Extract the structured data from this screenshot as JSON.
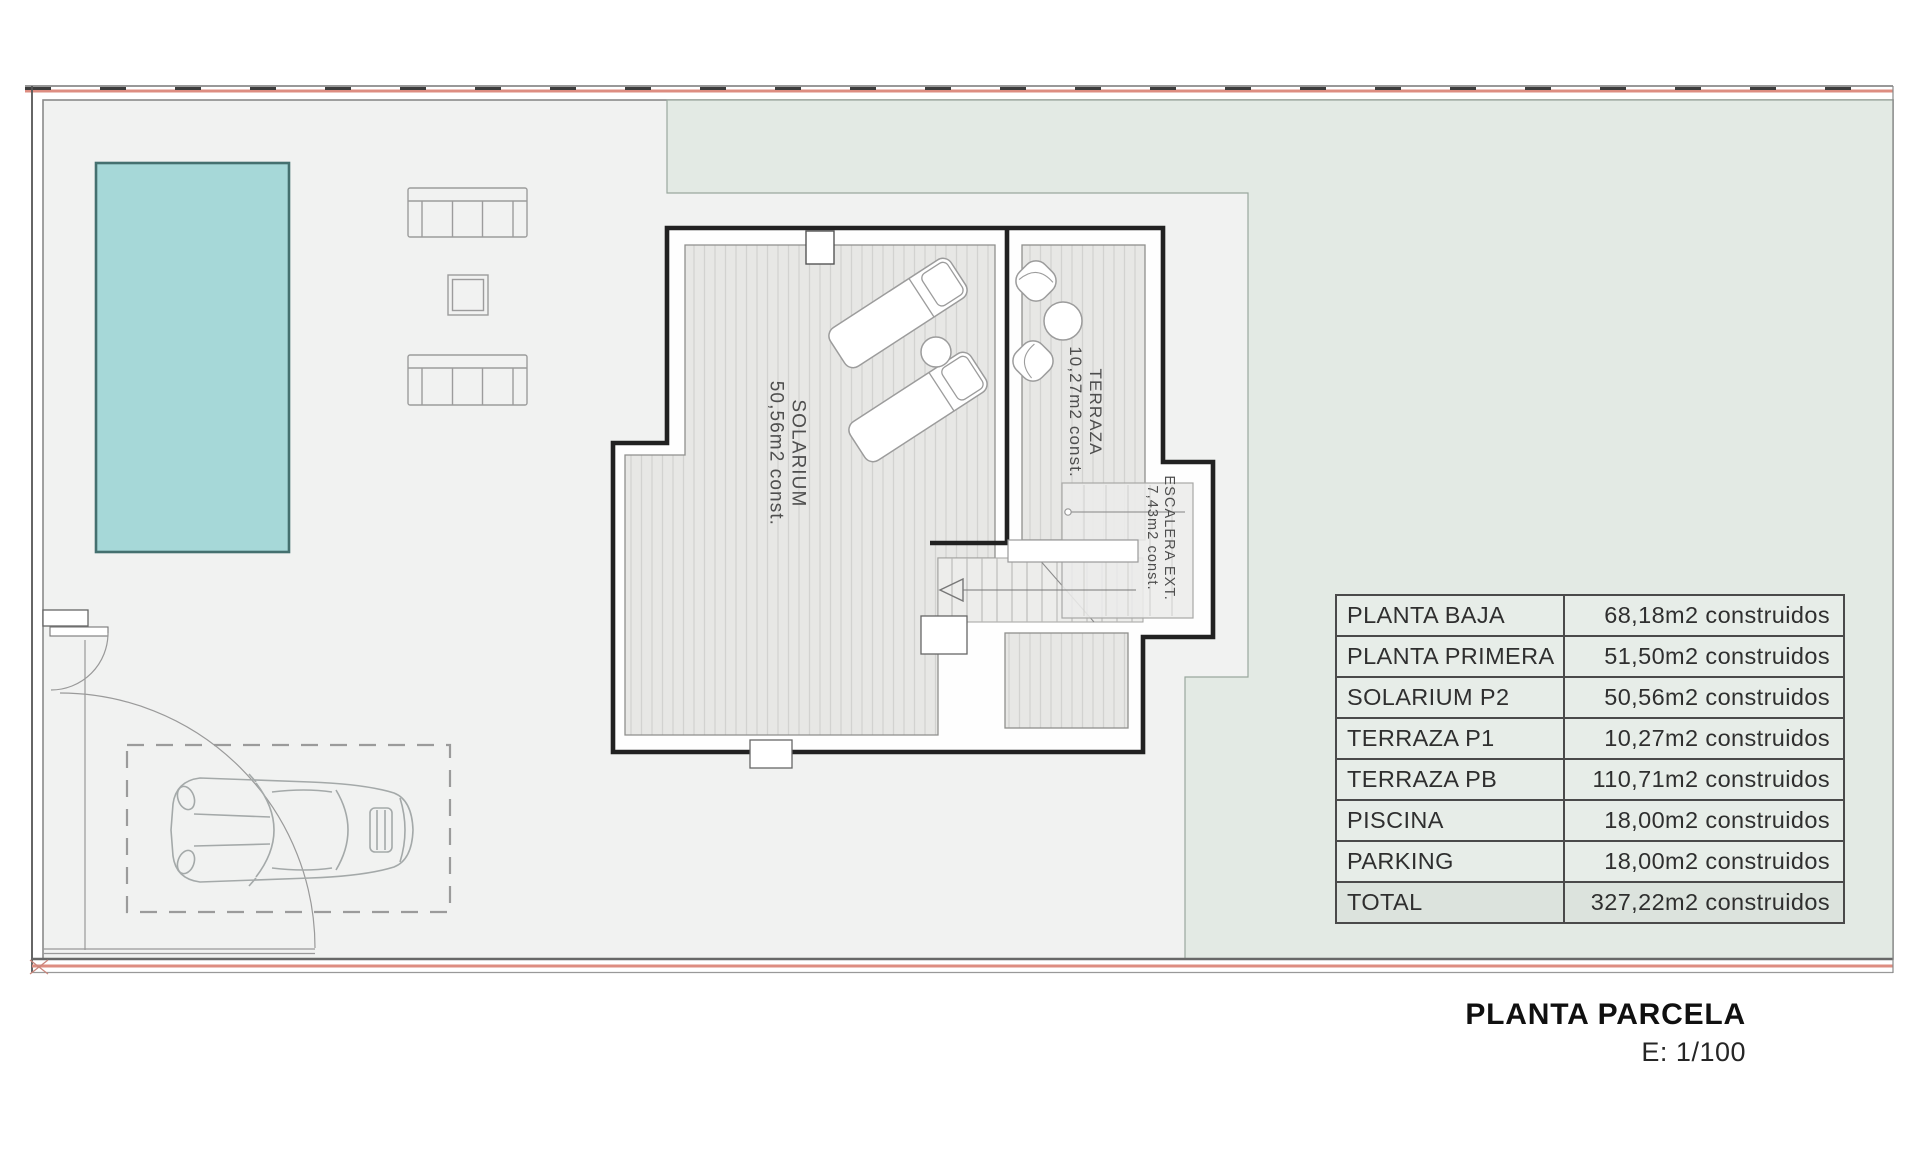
{
  "plan_labels": {
    "solarium": {
      "name": "SOLARIUM",
      "area": "50,56m2 const."
    },
    "terraza": {
      "name": "TERRAZA",
      "area": "10,27m2 const."
    },
    "escalera": {
      "name": "ESCALERA EXT.",
      "area": "7,43m2 const."
    }
  },
  "areas_table": {
    "rows": [
      {
        "label": "PLANTA BAJA",
        "value": "68,18m2 construidos"
      },
      {
        "label": "PLANTA PRIMERA",
        "value": "51,50m2 construidos"
      },
      {
        "label": "SOLARIUM P2",
        "value": "50,56m2 construidos"
      },
      {
        "label": "TERRAZA P1",
        "value": "10,27m2 construidos"
      },
      {
        "label": "TERRAZA PB",
        "value": "110,71m2 construidos"
      },
      {
        "label": "PISCINA",
        "value": "18,00m2 construidos"
      },
      {
        "label": "PARKING",
        "value": "18,00m2 construidos"
      },
      {
        "label": "TOTAL",
        "value": "327,22m2 construidos"
      }
    ]
  },
  "title_block": {
    "title": "PLANTA PARCELA",
    "scale": "E: 1/100"
  },
  "colors": {
    "pool_fill": "#a6d8d8",
    "garden_fill": "#e3eae4",
    "paving_fill": "#f1f2f1",
    "boundary_accent": "#dd8d81"
  }
}
